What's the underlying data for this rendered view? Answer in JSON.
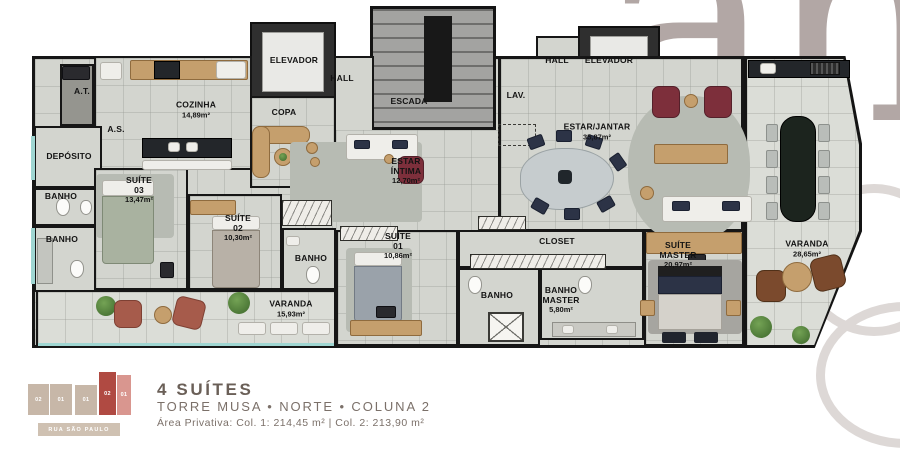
{
  "watermark": {
    "text": "ah"
  },
  "rooms": [
    {
      "id": "at",
      "name": "A.T.",
      "area": "",
      "x": 82,
      "y": 92
    },
    {
      "id": "cozinha",
      "name": "COZINHA",
      "area": "14,89m²",
      "x": 196,
      "y": 110
    },
    {
      "id": "copa",
      "name": "COPA",
      "area": "",
      "x": 284,
      "y": 113
    },
    {
      "id": "elevador-esq",
      "name": "ELEVADOR",
      "area": "",
      "x": 294,
      "y": 61
    },
    {
      "id": "hall-esq",
      "name": "HALL",
      "area": "",
      "x": 342,
      "y": 79
    },
    {
      "id": "escada",
      "name": "ESCADA",
      "area": "",
      "x": 409,
      "y": 102
    },
    {
      "id": "lav",
      "name": "LAV.",
      "area": "",
      "x": 516,
      "y": 96
    },
    {
      "id": "hall-dir",
      "name": "HALL",
      "area": "",
      "x": 557,
      "y": 61
    },
    {
      "id": "elevador-dir",
      "name": "ELEVADOR",
      "area": "",
      "x": 609,
      "y": 61
    },
    {
      "id": "estar-intima",
      "name": "ESTAR\nÍNTIMA",
      "area": "12,70m²",
      "x": 406,
      "y": 171
    },
    {
      "id": "estar-jantar",
      "name": "ESTAR/JANTAR",
      "area": "35,87m²",
      "x": 597,
      "y": 132
    },
    {
      "id": "deposito",
      "name": "DEPÓSITO",
      "area": "",
      "x": 69,
      "y": 157
    },
    {
      "id": "as",
      "name": "A.S.",
      "area": "",
      "x": 116,
      "y": 130
    },
    {
      "id": "banho-1",
      "name": "BANHO",
      "area": "",
      "x": 61,
      "y": 197
    },
    {
      "id": "banho-2",
      "name": "BANHO",
      "area": "",
      "x": 62,
      "y": 240
    },
    {
      "id": "suite-03",
      "name": "SUÍTE 03",
      "area": "13,47m²",
      "x": 139,
      "y": 190
    },
    {
      "id": "suite-02",
      "name": "SUÍTE 02",
      "area": "10,30m²",
      "x": 238,
      "y": 228
    },
    {
      "id": "banho-3",
      "name": "BANHO",
      "area": "",
      "x": 311,
      "y": 259
    },
    {
      "id": "suite-01",
      "name": "SUÍTE 01",
      "area": "10,86m²",
      "x": 398,
      "y": 246
    },
    {
      "id": "banho-4",
      "name": "BANHO",
      "area": "",
      "x": 497,
      "y": 296
    },
    {
      "id": "closet",
      "name": "CLOSET",
      "area": "",
      "x": 557,
      "y": 242
    },
    {
      "id": "banho-master",
      "name": "BANHO\nMASTER",
      "area": "5,80m²",
      "x": 561,
      "y": 300
    },
    {
      "id": "suite-master",
      "name": "SUÍTE MASTER",
      "area": "20,97m²",
      "x": 678,
      "y": 255
    },
    {
      "id": "varanda-1",
      "name": "VARANDA",
      "area": "15,93m²",
      "x": 291,
      "y": 309
    },
    {
      "id": "varanda-2",
      "name": "VARANDA",
      "area": "28,65m²",
      "x": 807,
      "y": 249
    }
  ],
  "footer": {
    "suites_title": "4 SUÍTES",
    "location_line": "TORRE MUSA • NORTE • COLUNA 2",
    "area_line": "Área Privativa: Col. 1: 214,45 m² | Col. 2: 213,90 m²",
    "street_label": "RUA SÃO PAULO",
    "sitemap_units": [
      "02",
      "01",
      "01",
      "02",
      "01"
    ]
  },
  "colors": {
    "wall": "#161616",
    "floor": "#d3d5cf",
    "varanda_floor": "#dbddd7",
    "wood": "#c59f6d",
    "watermark": "#b2a7a5",
    "footer_text": "#6a5f57",
    "map_highlight": "#b04a42"
  }
}
